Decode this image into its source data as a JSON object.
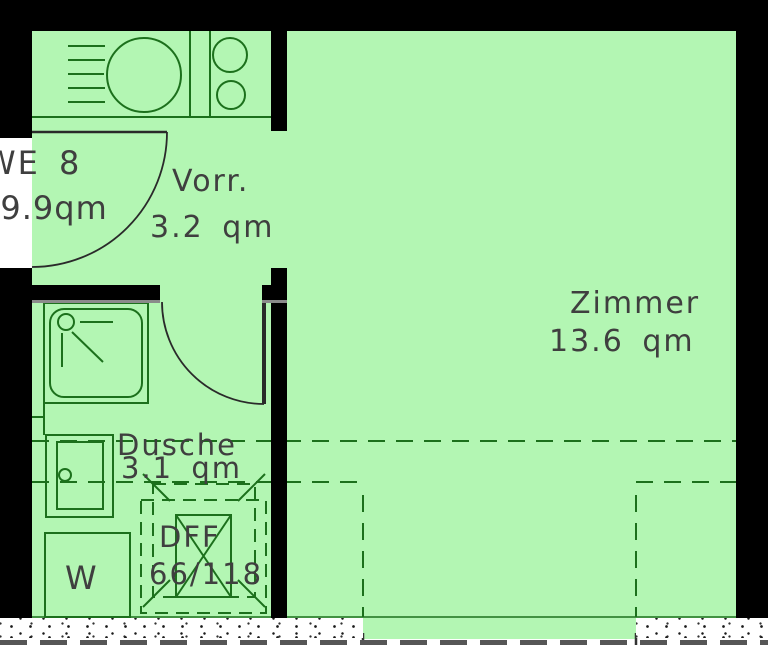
{
  "unit": {
    "label": "WE 8",
    "area": "19.9qm"
  },
  "rooms": [
    {
      "label": "Vorr.",
      "area": "3.2 qm"
    },
    {
      "label": "Zimmer",
      "area": "13.6 qm"
    },
    {
      "label": "Dusche",
      "area": "3.1 qm"
    }
  ],
  "roof_window": {
    "label": "DFF",
    "size": "66/118"
  },
  "washer_label": "W",
  "colors": {
    "room_fill": "#b3f6b3",
    "line_green": "#1c701c",
    "wall_black": "#000000",
    "text_gray": "#3f3f3f"
  }
}
